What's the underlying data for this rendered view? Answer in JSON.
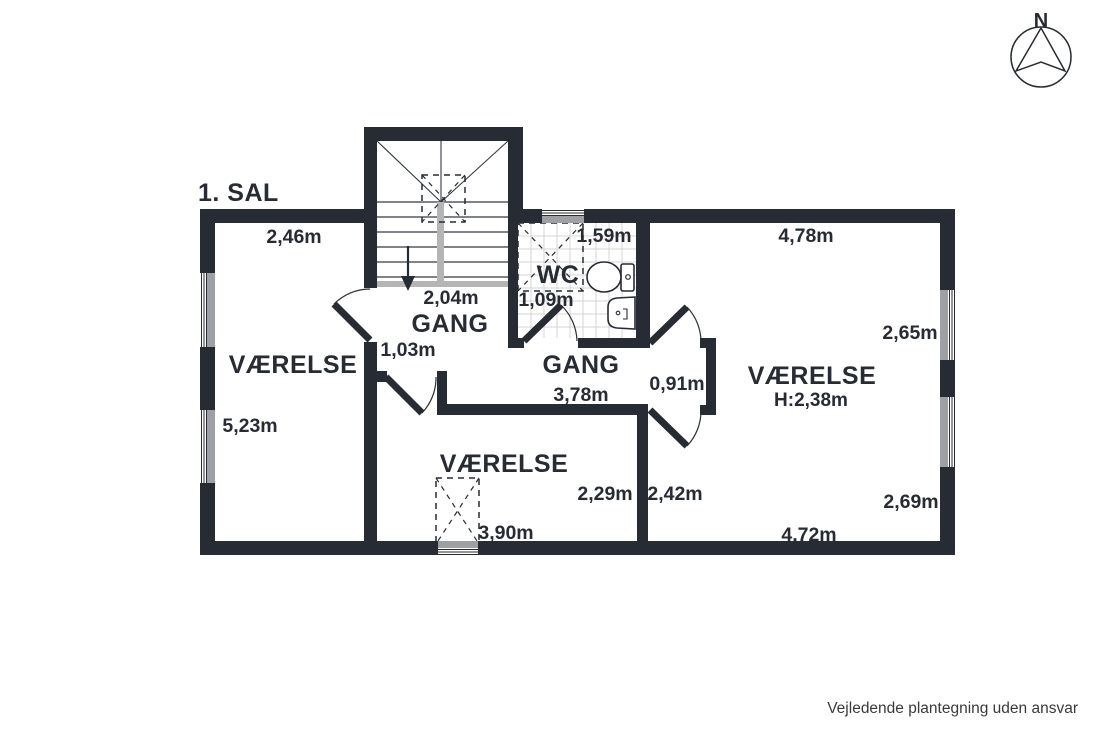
{
  "floor_label": "1. SAL",
  "disclaimer": "Vejledende plantegning uden ansvar",
  "compass_north": "N",
  "colors": {
    "wall": "#272b34",
    "window_gray": "#9ea0a5",
    "rail_gray": "#b5b5b5",
    "tile_gray": "#d4d4d4"
  },
  "rooms": {
    "room_left": {
      "label": "VÆRELSE",
      "dim_top": "2,46m",
      "dim_left": "5,23m"
    },
    "room_bottom": {
      "label": "VÆRELSE",
      "dim_bottom": "3,90m",
      "dim_right": "2,29m"
    },
    "room_right": {
      "label": "VÆRELSE",
      "ceiling_height": "H:2,38m",
      "dim_top": "4,78m",
      "dim_right_upper": "2,65m",
      "dim_right_lower": "2,69m",
      "dim_bottom": "4,72m",
      "dim_left": "2,42m"
    },
    "wc": {
      "label": "WC",
      "dim_top": "1,59m",
      "dim_left": "1,09m"
    },
    "hall_upper": {
      "label": "GANG",
      "dim_top": "2,04m",
      "dim_door": "1,03m"
    },
    "hall_lower": {
      "label": "GANG",
      "dim_bottom": "3,78m",
      "dim_door": "0,91m"
    }
  }
}
